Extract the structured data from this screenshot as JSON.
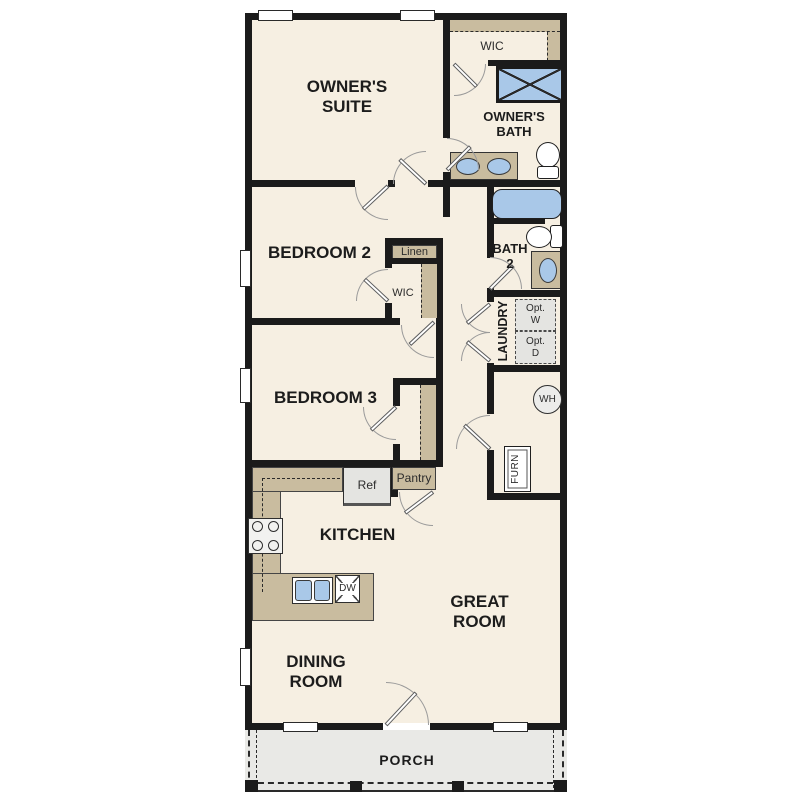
{
  "labels": {
    "owners_suite": "OWNER'S\nSUITE",
    "owner_wic": "WIC",
    "owners_bath": "OWNER'S\nBATH",
    "bedroom2": "BEDROOM 2",
    "linen": "Linen",
    "bedroom2_wic": "WIC",
    "bath2": "BATH\n2",
    "laundry": "LAUNDRY",
    "opt_w": "Opt.\nW",
    "opt_d": "Opt.\nD",
    "bedroom3": "BEDROOM 3",
    "water_heater": "WH",
    "furnace": "FURN",
    "fridge": "Ref",
    "pantry": "Pantry",
    "kitchen": "KITCHEN",
    "dishwasher": "DW",
    "great_room": "GREAT\nROOM",
    "dining_room": "DINING\nROOM",
    "porch": "PORCH"
  },
  "colors": {
    "wall": "#1b1b1b",
    "room_fill": "#f6efe2",
    "casework_tan": "#c9bc9f",
    "fixture_blue": "#a9c8e8",
    "appliance_gray": "#e4e4e1",
    "porch_gray": "#e9e9e6",
    "door_swing": "#9a9a9a"
  }
}
